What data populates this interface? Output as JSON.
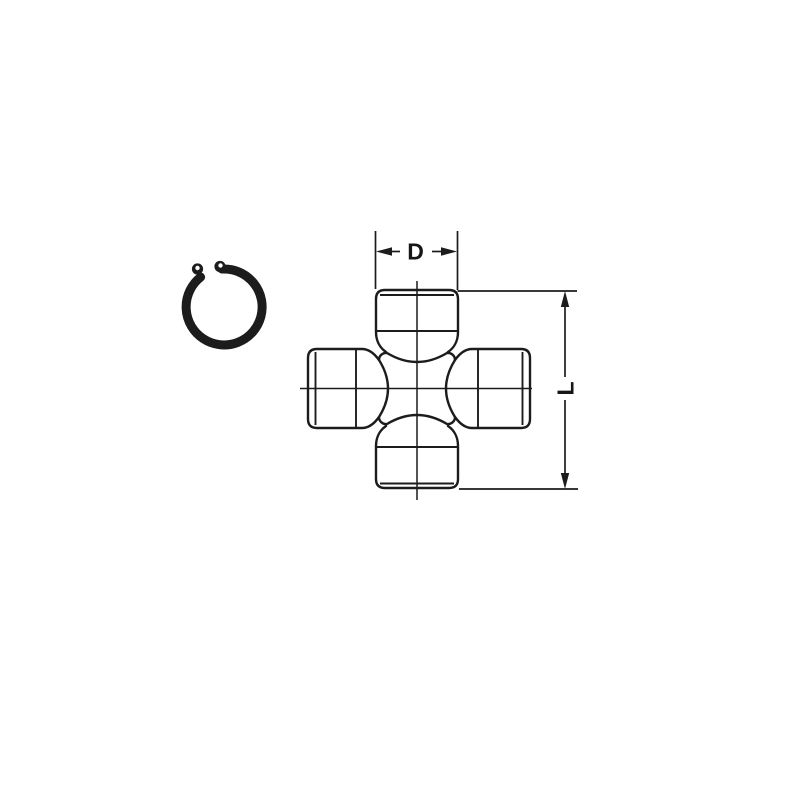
{
  "drawing": {
    "background_color": "#ffffff",
    "line_color": "#1c1c1c",
    "dimension_labels": {
      "diameter": "D",
      "length": "L"
    }
  }
}
